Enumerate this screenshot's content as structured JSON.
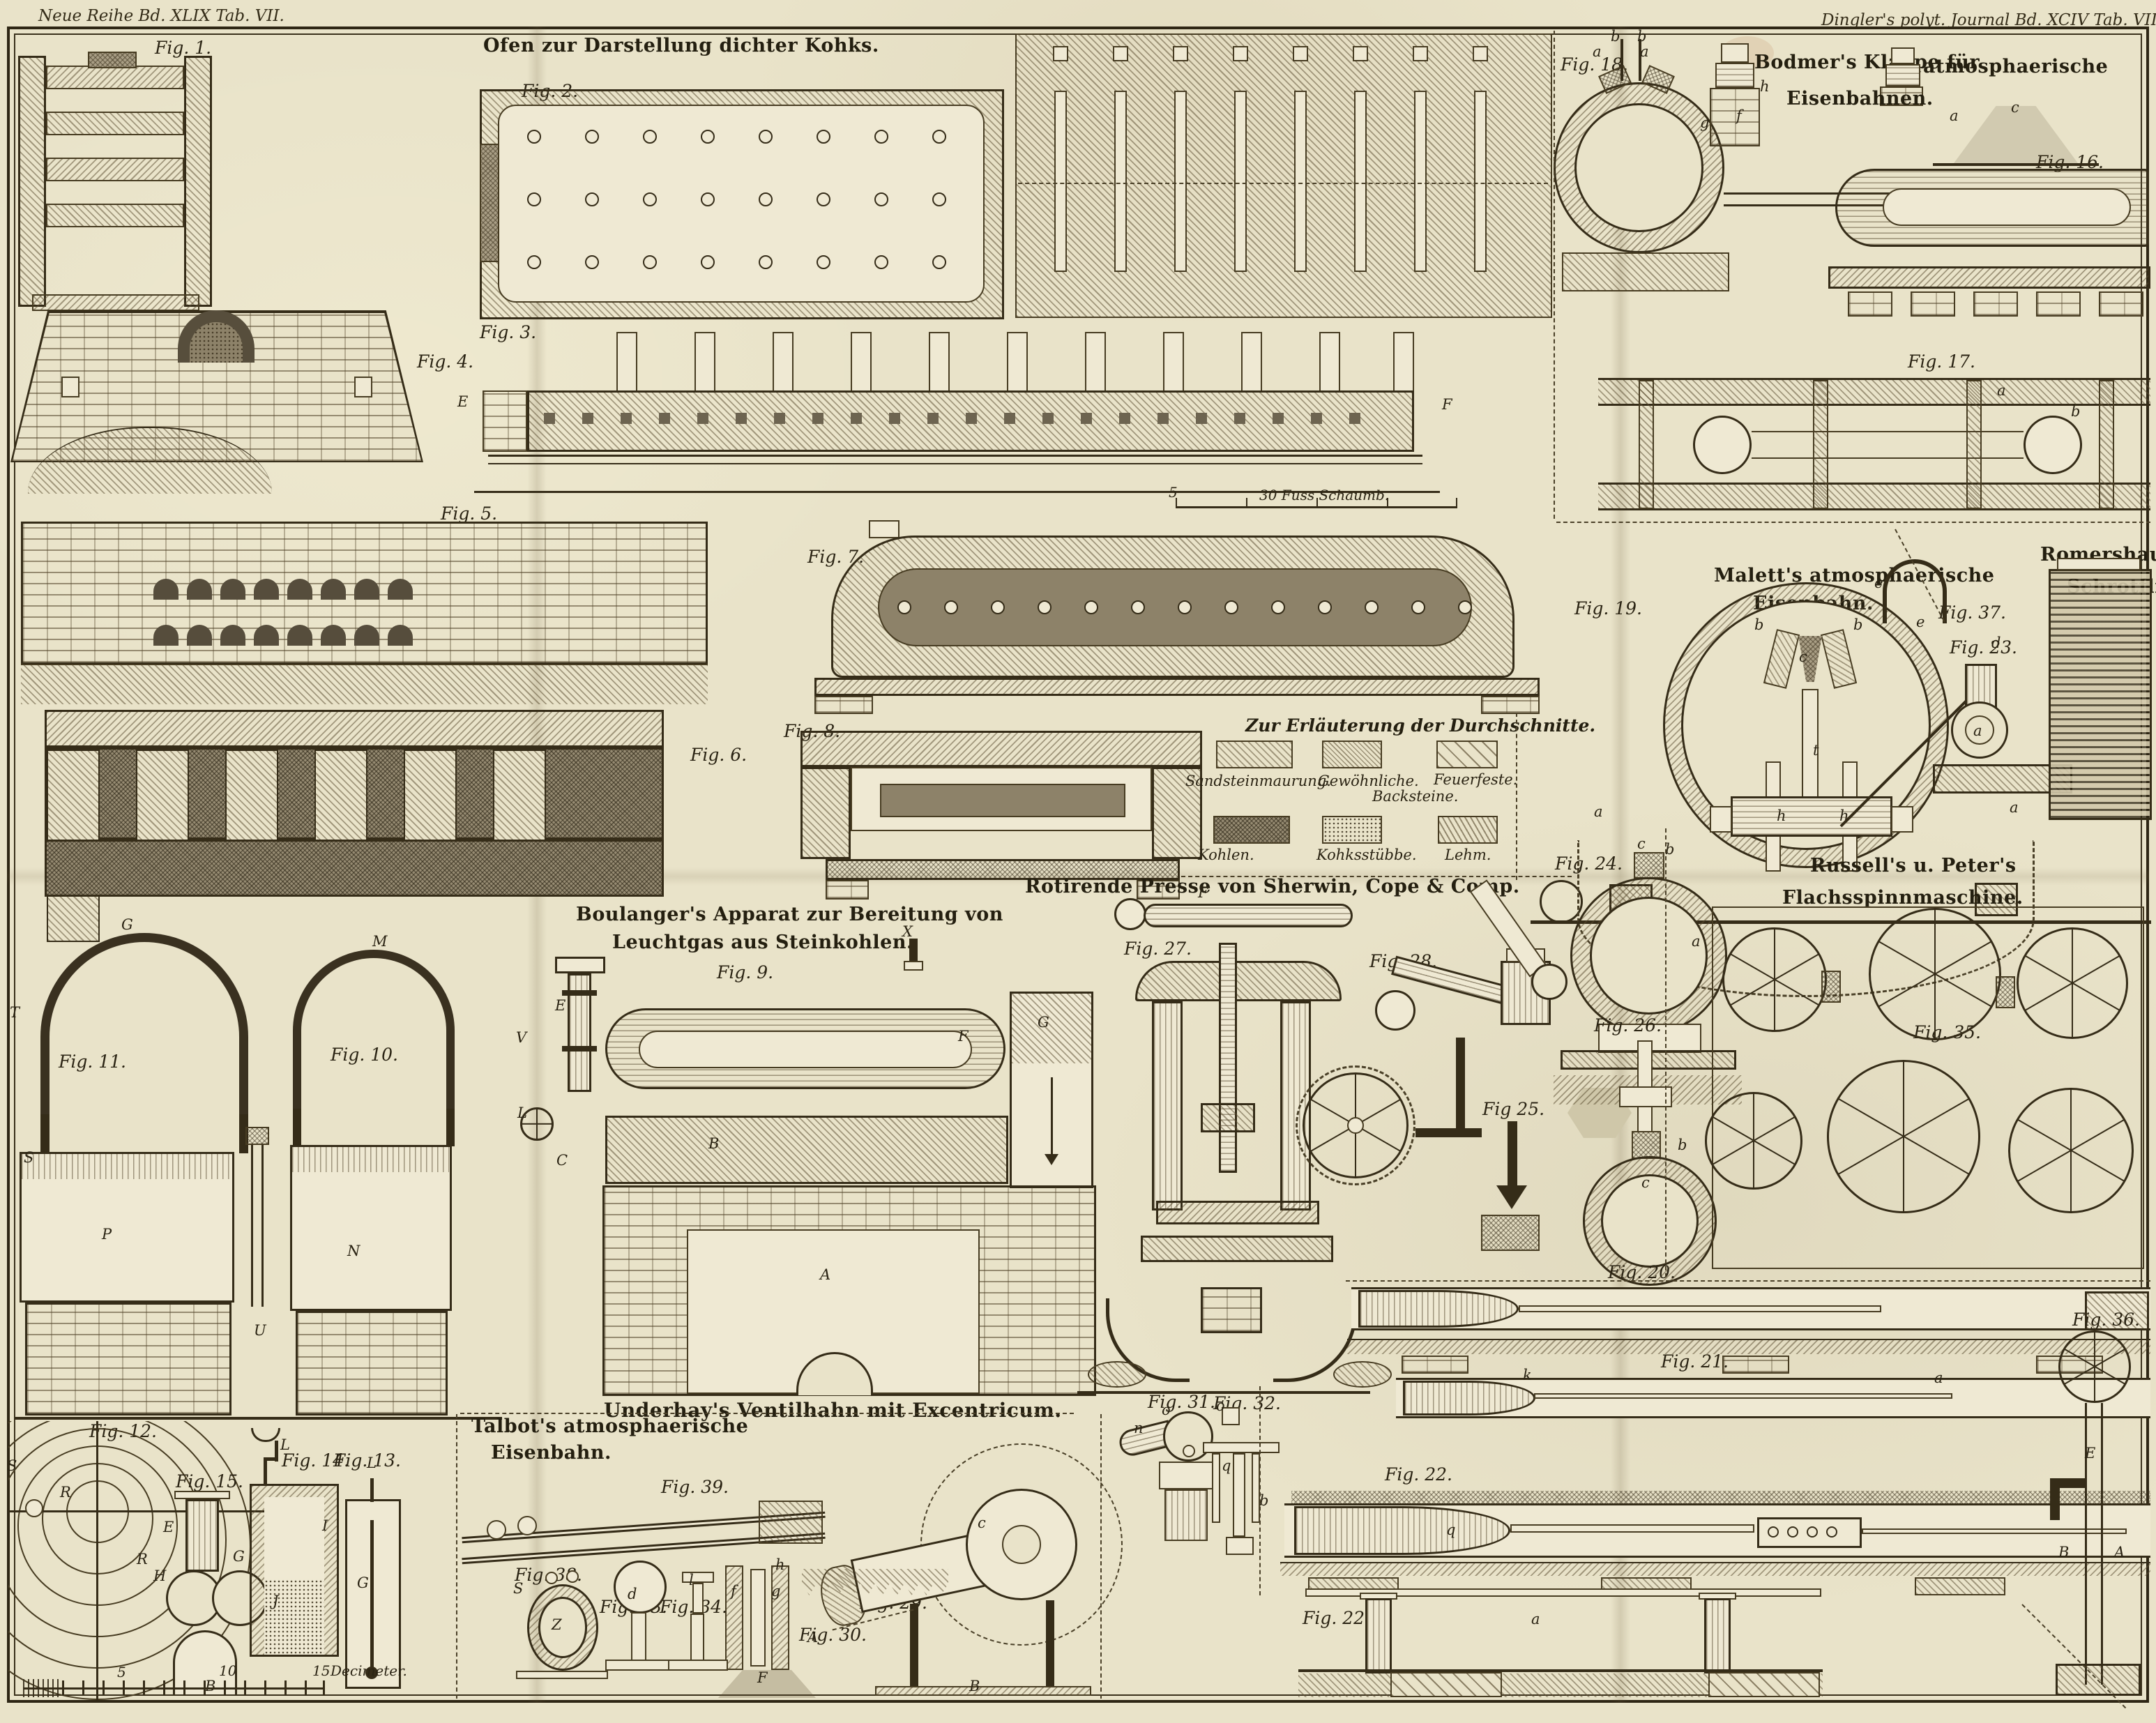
{
  "plate": {
    "margin_left": "Neue Reihe Bd. XLIX Tab. VII.",
    "margin_right": "Dingler's polyt. Journal Bd. XCIV Tab. VII."
  },
  "titles": {
    "ofen": "Ofen zur Darstellung dichter Kohks.",
    "bodmer_line1": "Bodmer's Klappe für",
    "bodmer_line2": "atmosphaerische",
    "bodmer_line3": "Eisenbahnen.",
    "boulanger_line1": "Boulanger's Apparat zur Bereitung von",
    "boulanger_line2": "Leuchtgas aus Steinkohlen.",
    "rotirende": "Rotirende Presse von Sherwin, Cope & Comp.",
    "malett_line1": "Malett's atmosphaerische",
    "malett_line2": "Eisenbahn.",
    "romershausen_line1": "Romershausen's",
    "romershausen_line2": "Schrotflinte.",
    "russell_line1": "Russell's u. Peter's",
    "russell_line2": "Flachsspinnmaschine.",
    "talbot_line1": "Talbot's atmosphaerische",
    "talbot_line2": "Eisenbahn.",
    "underhay": "Underhay's Ventilhahn mit Excentricum."
  },
  "legend": {
    "title": "Zur Erläuterung der Durchschnitte.",
    "items": [
      {
        "label": "Sandsteinmaurung.",
        "sub": "",
        "pattern": "diagonal-hatch"
      },
      {
        "label": "Gewöhnliche.",
        "sub": "Backsteine.",
        "pattern": "fine-diagonal-hatch"
      },
      {
        "label": "Feuerfeste.",
        "sub": "",
        "pattern": "sparse-diagonal-dashes"
      },
      {
        "label": "Kohlen.",
        "sub": "",
        "pattern": "dark-crosshatch"
      },
      {
        "label": "Kohksstübbe.",
        "sub": "",
        "pattern": "stipple"
      },
      {
        "label": "Lehm.",
        "sub": "",
        "pattern": "steep-diagonal-hatch"
      }
    ]
  },
  "scales": {
    "fuss_tick": "5",
    "fuss_label": "30 Fuss Schaumb.",
    "dm_tick1": "5",
    "dm_tick2": "10",
    "dm_tick3": "15",
    "dm_label": "Decimeter."
  },
  "fig_labels": {
    "f1": "Fig. 1.",
    "f2": "Fig. 2.",
    "f3": "Fig. 3.",
    "f4": "Fig. 4.",
    "f5": "Fig. 5.",
    "f6": "Fig. 6.",
    "f7": "Fig. 7.",
    "f8": "Fig. 8.",
    "f9": "Fig. 9.",
    "f10": "Fig. 10.",
    "f11": "Fig. 11.",
    "f12": "Fig. 12.",
    "f13": "Fig. 13.",
    "f14": "Fig. 14.",
    "f15": "Fig. 15.",
    "f16": "Fig. 16.",
    "f17": "Fig. 17.",
    "f18": "Fig. 18.",
    "f19": "Fig. 19.",
    "f20": "Fig. 20.",
    "f21": "Fig. 21.",
    "f22": "Fig. 22.",
    "f22a": "Fig. 22.a",
    "f23": "Fig. 23.",
    "f24": "Fig. 24.",
    "f25": "Fig 25.",
    "f26": "Fig. 26.",
    "f27": "Fig. 27.",
    "f28": "Fig. 28.",
    "f29": "Fig. 29.",
    "f30": "Fig. 30.",
    "f31": "Fig. 31.",
    "f32": "Fig. 32.",
    "f33": "Fig. 33.",
    "f34": "Fig. 34.",
    "f35": "Fig. 35.",
    "f36": "Fig. 36.",
    "f37": "Fig. 37.",
    "f38": "Fig. 38.",
    "f39": "Fig. 39."
  },
  "letters": {
    "l01": "E",
    "l02": "F",
    "l03": "X",
    "l04": "E",
    "l05": "V",
    "l06": "L",
    "l07": "C",
    "l08": "B",
    "l09": "A",
    "l10": "F",
    "l11": "G",
    "l12": "G",
    "l13": "M",
    "l14": "T",
    "l15": "P",
    "l16": "N",
    "l17": "S",
    "l18": "U",
    "l19": "S",
    "l20": "R",
    "l21": "R",
    "l22": "E",
    "l23": "H",
    "l24": "F",
    "l25": "B",
    "l26": "L",
    "l27": "G",
    "l28": "J",
    "l29": "I",
    "l30": "L",
    "l31": "G",
    "l32": "b",
    "l33": "b",
    "l34": "a",
    "l35": "a",
    "l36": "h",
    "l37": "f",
    "l38": "g",
    "l39": "a",
    "l40": "c",
    "l41": "a",
    "l42": "b",
    "l43": "b",
    "l44": "b",
    "l45": "c",
    "l46": "t",
    "l47": "h",
    "l48": "h",
    "l49": "a",
    "l50": "a",
    "l51": "e",
    "l52": "e",
    "l53": "d",
    "l54": "a",
    "l55": "a",
    "l56": "c",
    "l57": "b",
    "l58": "b",
    "l59": "c",
    "l60": "F",
    "l61": "R",
    "l62": "k",
    "l63": "a",
    "l64": "b",
    "l65": "q",
    "l66": "a",
    "l67": "c",
    "l68": "A",
    "l69": "B",
    "l70": "f",
    "l71": "g",
    "l72": "h",
    "l73": "F",
    "l74": "o",
    "l75": "n",
    "l76": "o",
    "l77": "q",
    "l78": "Z",
    "l79": "S",
    "l80": "d",
    "l81": "l",
    "l82": "E",
    "l83": "B",
    "l84": "A"
  }
}
